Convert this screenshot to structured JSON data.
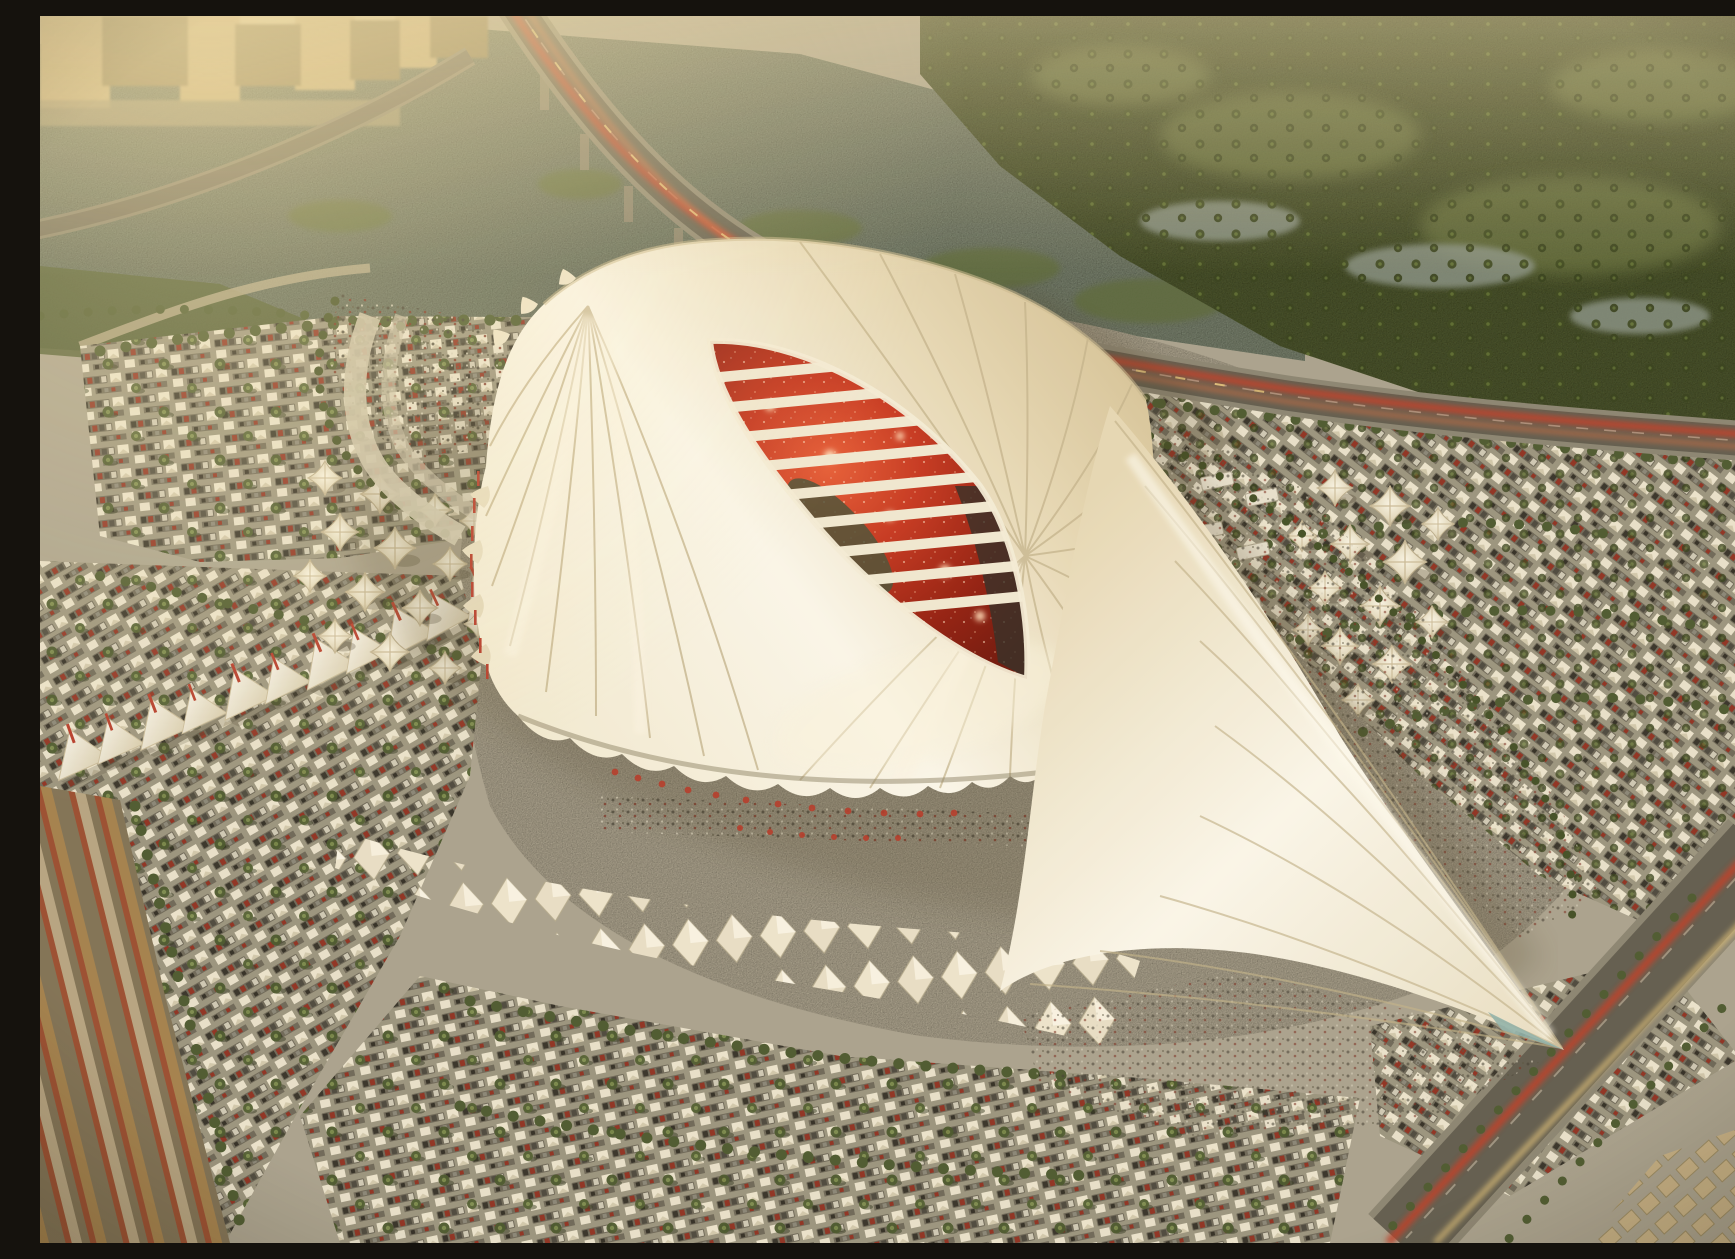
{
  "meta": {
    "description": "Aerial dusk rendering of a seashell-shaped stadium with pleated white tensile roof, red stands visible through a spiral eye opening, a long white wing canopy sweeping southeast, surrounded by shaded parking fields with white car tents, palm rows, tensile cone tents, a diamond-sail canopy field, crowds on plazas, a waterway with curving elevated highway with glowing tail-lights, hazy city skyline and dark-green palm parkland"
  },
  "palette": {
    "ground": "#a9a291",
    "plaza": "#bdb5a2",
    "water": "#7f8b7a",
    "park": "#4e5a33",
    "park_light": "#687543",
    "palm": "#4a5830",
    "hedge": "#3f4d26",
    "city": "#c3aa79",
    "city_shadow": "#8d7b55",
    "asphalt": "#9a9481",
    "asphalt_dark": "#807b6c",
    "car_dark": "#3a372f",
    "car_red": "#8e2f23",
    "car_white": "#cfc9b8",
    "tent": "#ece5d1",
    "roof_cream": "#f3ebd4",
    "roof_white": "#fcf9ef",
    "roof_tan": "#e7d9b8",
    "roof_deep": "#d3c096",
    "roof_line": "#c2b28d",
    "rib": "#f2ead6",
    "eye_bright": "#e85c38",
    "eye_mid": "#c63520",
    "eye_deep": "#931c10",
    "eye_edge": "#70140b",
    "pitch": "#4a5038",
    "stand_dark": "#2e2b26",
    "glow": "#ffd9b8",
    "road": "#5f5b50",
    "road_edge": "#8a8474",
    "taillight": "#c23a28",
    "headlight": "#e8c87e",
    "boulevard_amber": "#9c7a4e",
    "crowd": "#3f3b33",
    "teal": "#8fb3ae",
    "mast_red": "#b5382a",
    "blocks": "#c6b087",
    "haze": "#e8d7ab"
  },
  "scene": {
    "stadium": "shell-shaped stadium roof",
    "opening": "spiral eye opening showing red stands",
    "wing": "long white wing canopy to the southeast",
    "waterway": "river channel with green islands",
    "bridge": "elevated curving highway with red light trails",
    "park": "dark palm parkland north-east",
    "city": "hazy sunlit skyline north-west",
    "parking": "tented parking fields with palm rows",
    "cone_tents": "clusters of tensile cone tents",
    "diamond_canopies": "interlocking diamond shade sails",
    "sail_arcade": "arc of large sail canopies south-west",
    "crowds": "spectator crowds on plazas",
    "boulevard": "striped boulevard south-west corner",
    "se_road": "highway with light trails south-east corner"
  }
}
